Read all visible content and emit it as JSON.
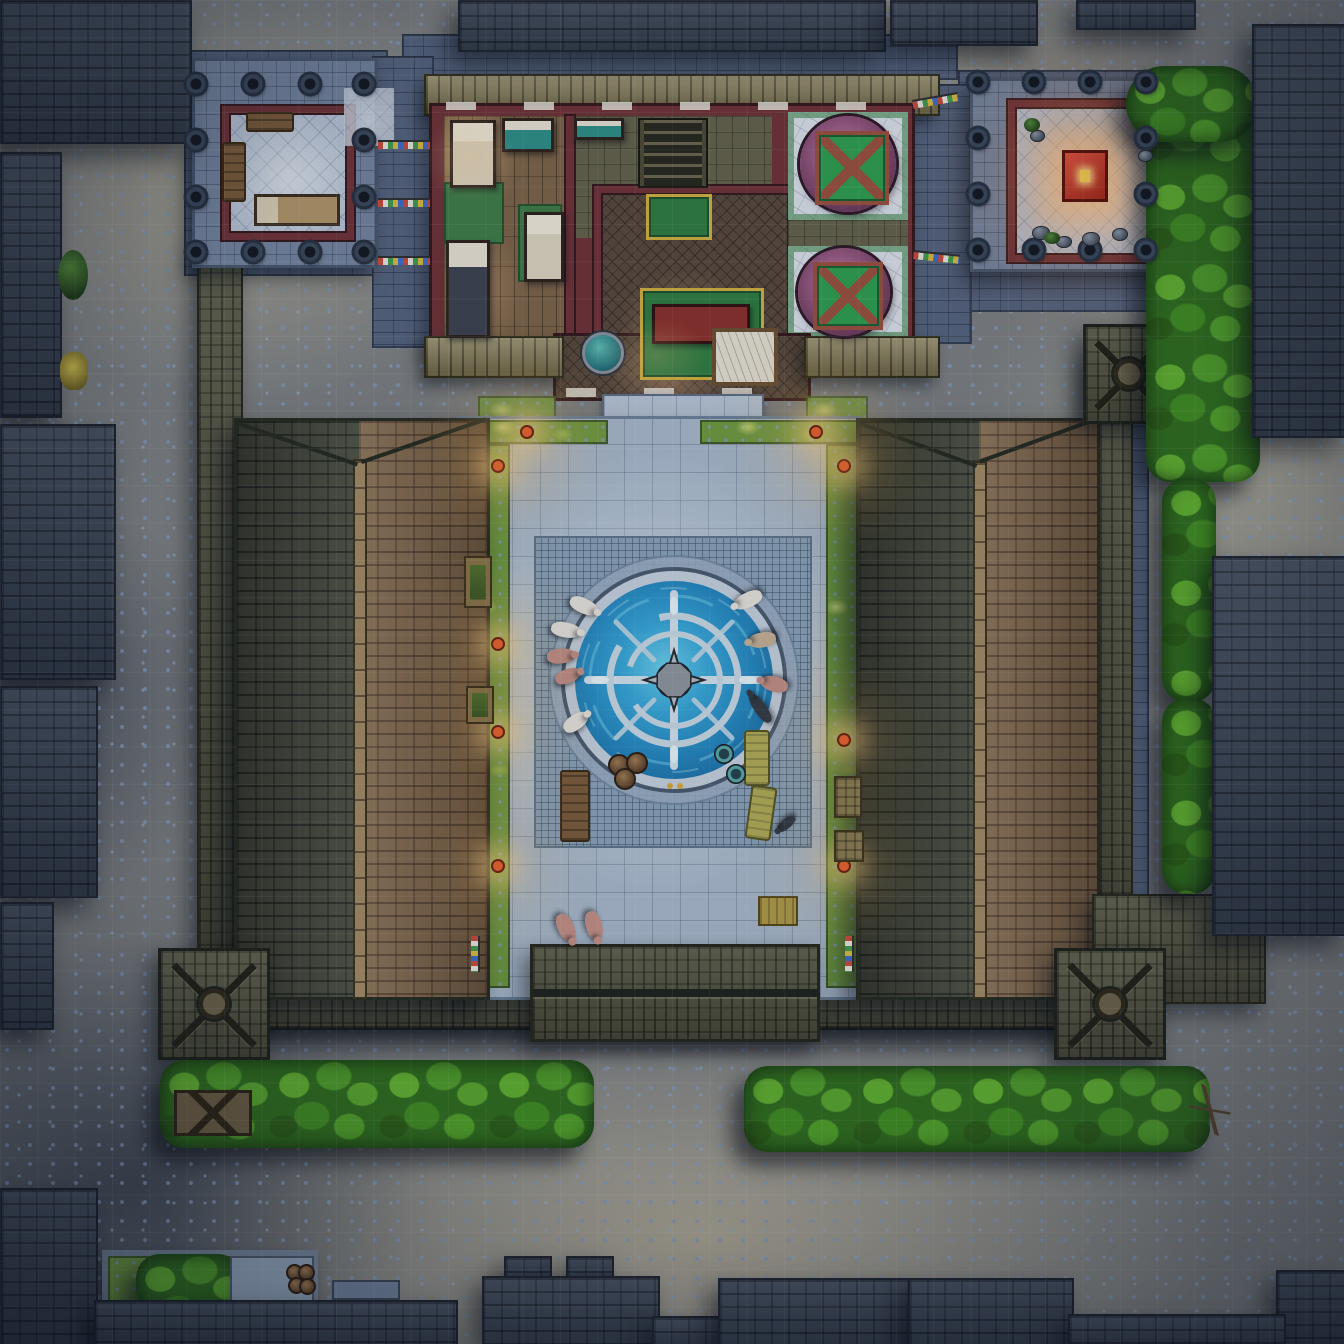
{
  "scene": {
    "kind": "top-down fantasy battlemap",
    "setting": "night-time walled temple compound: northern residence with bath rooms, twin tile-roofed halls flanking a paved courtyard with a glowing compass-rose fountain, hedges and dark city roofs around the perimeter",
    "time_of_day": "night",
    "visible_text": "none"
  },
  "grid": {
    "columns": 36,
    "rows": 36,
    "cell_px": 37.33,
    "line_color": "#ffffff",
    "line_opacity": 0.055
  },
  "palette": {
    "street": "#8e8c83",
    "pebble": "#7e96b6",
    "roof-dark": "#3a4454",
    "roof-olive": "#565742",
    "roof-brown": "#7f6448",
    "roof-green": "#474b3c",
    "ridge-tan": "#a28a64",
    "platform": "#74849e",
    "pale-floor": "#b8c3d4",
    "red-wall": "#6e3136",
    "wood-floor": "#7d6347",
    "olive-floor": "#64624a",
    "herringbone": "#57473b",
    "marble": "#dde2ea",
    "tub-purple": "#7c4468",
    "cover-green": "#2f9f4f",
    "frame-red": "#9a4f3c",
    "mat-green": "#3f7d46",
    "bed-teal": "#2e8f86",
    "courtyard": "#a9b9cb",
    "mosaic": "#8ba2b8",
    "water-deep": "#1f7fb8",
    "water-bright": "#5cc6e8",
    "rim": "#c7d2df",
    "grass": "#6f9a3f",
    "hedge": "#2e6b1c",
    "hedge-light": "#5fae2e",
    "glow": "#ffd98e",
    "lantern": "#e8612c",
    "pig-pink": "#c49084",
    "pig-white": "#e8e4dc",
    "animal-dark": "#343a42"
  },
  "placements": {
    "pillars": [
      [
        196,
        84
      ],
      [
        253,
        84
      ],
      [
        310,
        84
      ],
      [
        364,
        84
      ],
      [
        196,
        140
      ],
      [
        364,
        140
      ],
      [
        196,
        197
      ],
      [
        364,
        197
      ],
      [
        196,
        252
      ],
      [
        253,
        252
      ],
      [
        310,
        252
      ],
      [
        364,
        252
      ],
      [
        978,
        82
      ],
      [
        1034,
        82
      ],
      [
        1090,
        82
      ],
      [
        1146,
        82
      ],
      [
        978,
        138
      ],
      [
        1146,
        138
      ],
      [
        978,
        194
      ],
      [
        1146,
        194
      ],
      [
        978,
        250
      ],
      [
        1034,
        250
      ],
      [
        1090,
        250
      ],
      [
        1146,
        250
      ]
    ],
    "lanterns": [
      [
        498,
        466
      ],
      [
        498,
        644
      ],
      [
        498,
        732
      ],
      [
        498,
        866
      ],
      [
        844,
        466
      ],
      [
        844,
        740
      ],
      [
        844,
        866
      ],
      [
        527,
        432
      ],
      [
        816,
        432
      ]
    ],
    "flags": [
      [
        378,
        140,
        52,
        0
      ],
      [
        378,
        198,
        52,
        0
      ],
      [
        378,
        256,
        52,
        0
      ],
      [
        912,
        100,
        46,
        -10
      ],
      [
        914,
        250,
        46,
        6
      ],
      [
        480,
        936,
        36,
        90
      ],
      [
        854,
        936,
        36,
        90
      ]
    ],
    "animals": [
      [
        584,
        606,
        115,
        "white",
        15,
        30
      ],
      [
        566,
        630,
        100,
        "white",
        15,
        30
      ],
      [
        561,
        656,
        85,
        "pink",
        15,
        28
      ],
      [
        568,
        676,
        70,
        "pink",
        14,
        26
      ],
      [
        576,
        722,
        55,
        "white",
        15,
        28
      ],
      [
        748,
        600,
        -115,
        "white",
        15,
        30
      ],
      [
        762,
        640,
        -100,
        "tan",
        15,
        28
      ],
      [
        774,
        684,
        -75,
        "pink",
        15,
        28
      ],
      [
        760,
        708,
        -35,
        "dark",
        12,
        34
      ],
      [
        566,
        928,
        155,
        "pink",
        16,
        30
      ],
      [
        594,
        926,
        165,
        "pink",
        16,
        30
      ],
      [
        786,
        824,
        -130,
        "dark",
        10,
        22
      ]
    ],
    "props": [
      [
        "bench-wood",
        560,
        770,
        26,
        68,
        0
      ],
      [
        "bench-moss",
        744,
        730,
        22,
        52,
        0
      ],
      [
        "bench-moss",
        748,
        786,
        22,
        50,
        8
      ],
      [
        "bench-wood",
        246,
        112,
        44,
        16,
        0
      ],
      [
        "bench-wood",
        222,
        142,
        20,
        56,
        0
      ],
      [
        "planter",
        464,
        556,
        24,
        48,
        0
      ],
      [
        "planter",
        466,
        686,
        24,
        34,
        0
      ],
      [
        "crate",
        834,
        776,
        24,
        38,
        0
      ],
      [
        "crate",
        834,
        830,
        26,
        28,
        0
      ],
      [
        "crate-yellow",
        758,
        896,
        36,
        26,
        0
      ],
      [
        "crate-street",
        174,
        1090,
        72,
        40,
        0
      ],
      [
        "bench-stone",
        332,
        1280,
        64,
        16,
        0
      ],
      [
        "pot",
        608,
        754,
        18,
        18,
        0
      ],
      [
        "pot",
        626,
        752,
        18,
        18,
        0
      ],
      [
        "pot",
        614,
        768,
        18,
        18,
        0
      ],
      [
        "pot-ring",
        714,
        744,
        18,
        18,
        0
      ],
      [
        "pot-ring",
        726,
        764,
        18,
        18,
        0
      ],
      [
        "pot",
        286,
        1264,
        13,
        13,
        0
      ],
      [
        "pot",
        298,
        1264,
        13,
        13,
        0
      ],
      [
        "pot",
        288,
        1277,
        13,
        13,
        0
      ],
      [
        "pot",
        299,
        1278,
        13,
        13,
        0
      ],
      [
        "rock",
        1032,
        226,
        16,
        12,
        0
      ],
      [
        "rock",
        1056,
        236,
        14,
        10,
        0
      ],
      [
        "rock",
        1082,
        232,
        16,
        12,
        0
      ],
      [
        "rock",
        1112,
        228,
        14,
        11,
        0
      ],
      [
        "rock",
        1138,
        150,
        13,
        10,
        0
      ],
      [
        "rock",
        1030,
        130,
        13,
        10,
        0
      ],
      [
        "plant",
        1024,
        118,
        16,
        14,
        0
      ],
      [
        "plant",
        1044,
        232,
        16,
        12,
        0
      ],
      [
        "plant",
        58,
        250,
        30,
        50,
        0
      ],
      [
        "plant-yellow",
        60,
        352,
        28,
        38,
        0
      ],
      [
        "branch",
        1190,
        1090,
        40,
        40,
        25
      ]
    ]
  }
}
